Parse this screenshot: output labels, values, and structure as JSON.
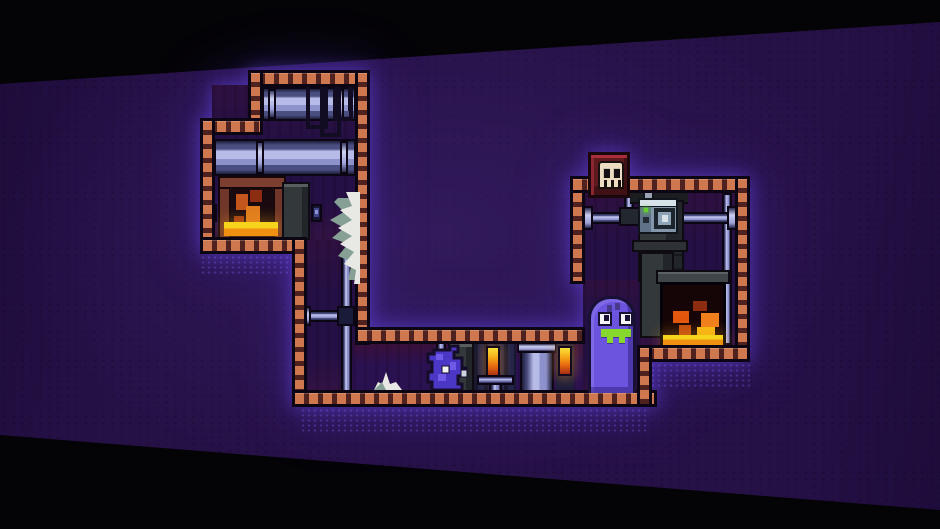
{
  "scene": {
    "description": "pixel-art dungeon platformer level seen from side view",
    "canvas": {
      "width": 940,
      "height": 529
    }
  },
  "palette": {
    "bg-field": "#261147",
    "bg-field-dark": "#1e0c3c",
    "wall": "#cf7850",
    "wall-stud": "#4f2220",
    "outline": "#0c0614",
    "interior": "#241045",
    "pipe-light": "#b7bbe7",
    "pipe-mid": "#8d91cc",
    "pipe-dark": "#4b4e80",
    "pipe-darkest": "#1d1e3a",
    "metal-grey": "#33383b",
    "metal-grey-dark": "#22262a",
    "metal-grey-light": "#585e5d",
    "safe-body": "#8496aa",
    "safe-top": "#d8e2ea",
    "led-green": "#64d22e",
    "fire-orange": "#e07b1e",
    "fire-red": "#8c2d12",
    "lava-yellow": "#f6d41c",
    "lava-orange": "#ef9012",
    "brick-red": "#7c3e31",
    "skull-block": "#5f1a20",
    "skull-face": "#ecdcc2",
    "ghost-purple": "#6c54de",
    "critter-purple": "#4a37c6",
    "teeth-green": "#86d92c",
    "web-white": "#e8e9e4",
    "web-shadow": "#87a096",
    "candle-top": "#f8e238",
    "candle-bottom": "#a42d14"
  },
  "entities": {
    "ghost": "purple ghost enemy with green teeth",
    "critter": "small purple critter enemy",
    "skull_block": "red skull block",
    "fireplace_left": "brick fireplace with lava",
    "fireplace_right": "stone fireplace with lava",
    "safe": "metal safe with dial and green light",
    "cobweb_large": "large torn cobweb",
    "cobweb_small": "small floor cobweb",
    "candle": "glowing wall candle",
    "pipe": "metal pipe"
  }
}
